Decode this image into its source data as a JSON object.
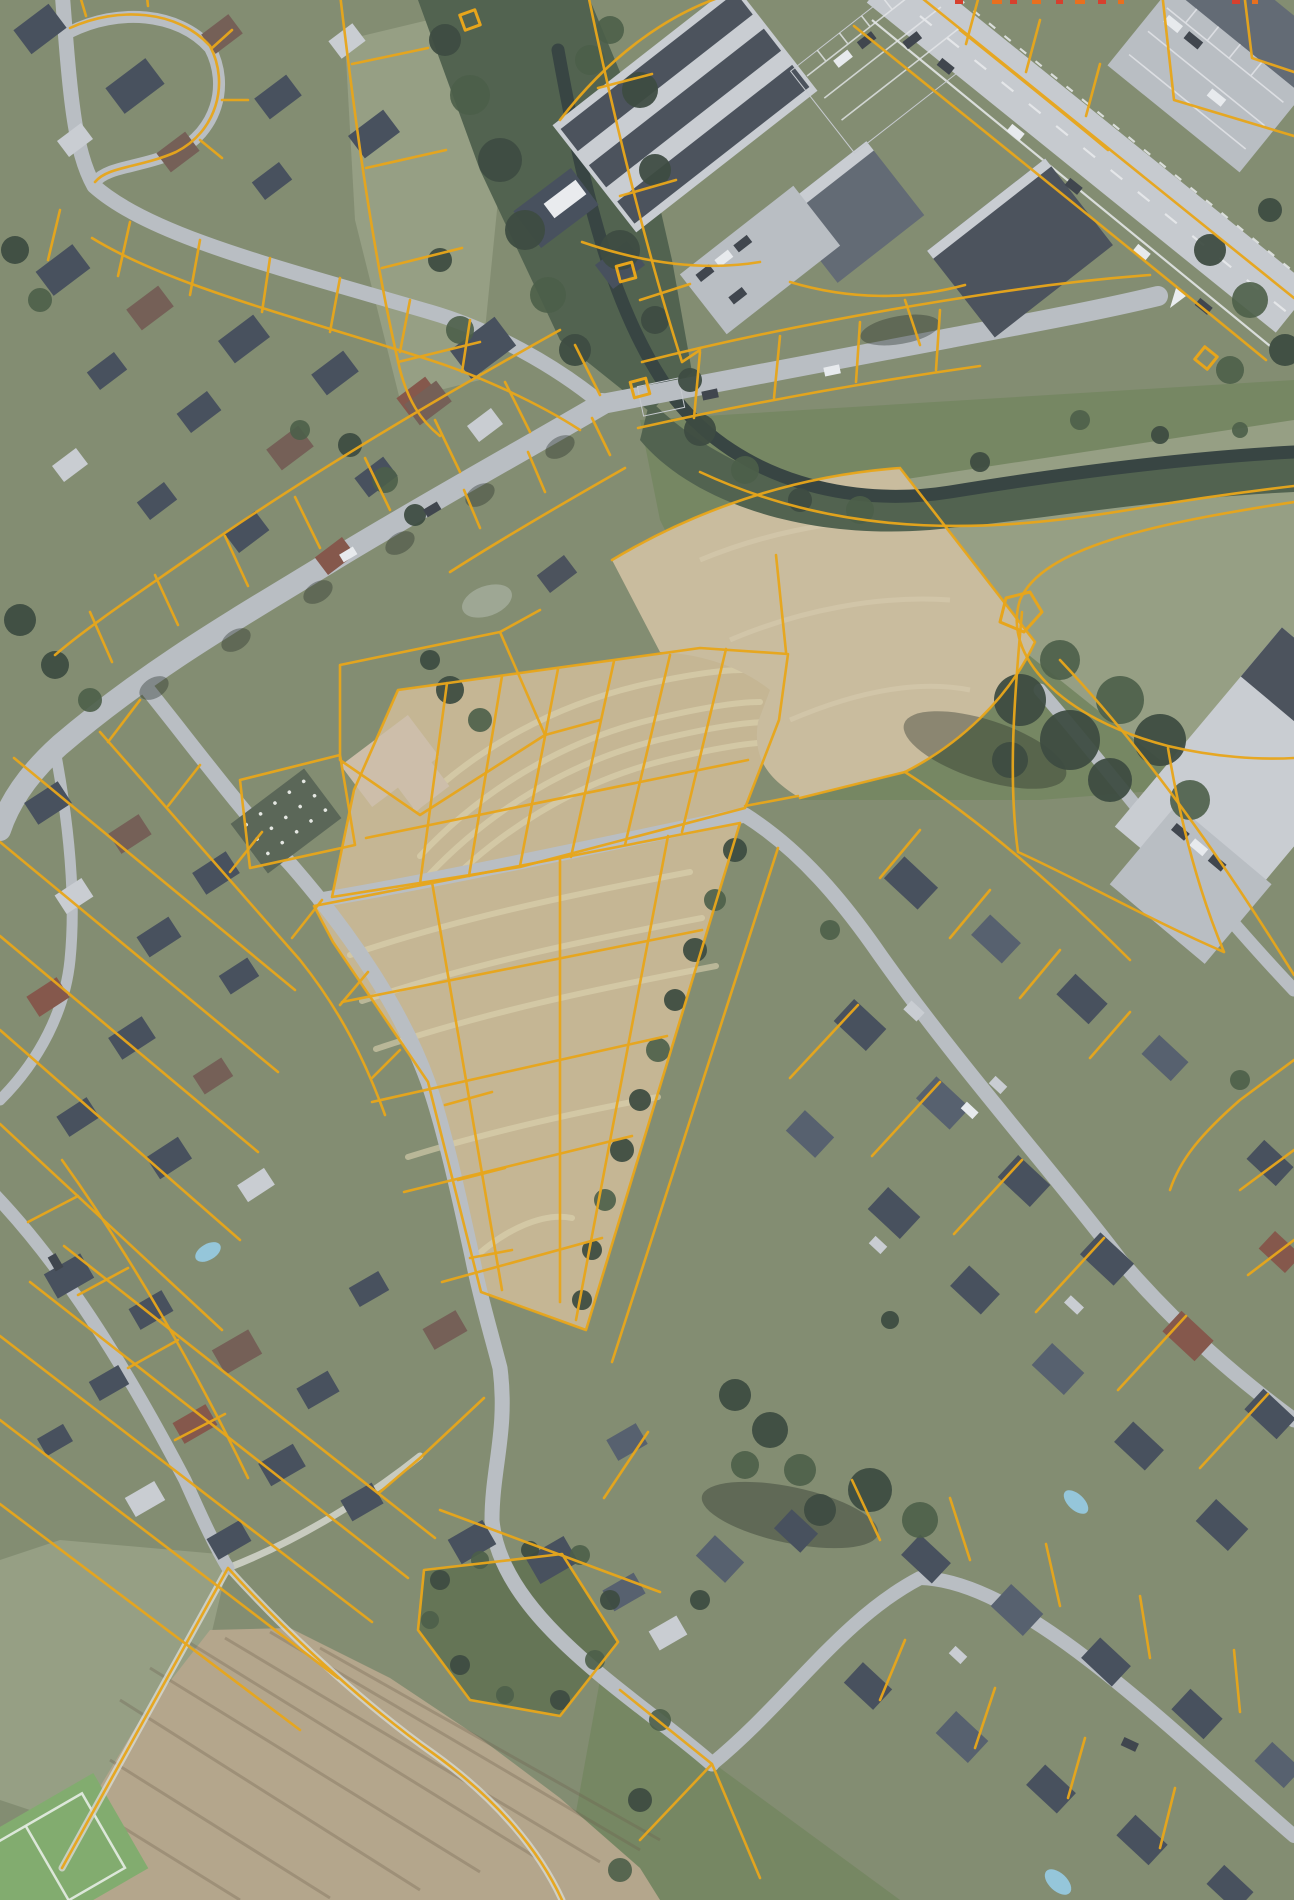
{
  "canvas": {
    "width": 1294,
    "height": 1900
  },
  "scene": {
    "type": "aerial-orthophoto-with-cadastral-overlay",
    "description": "Top-down aerial photograph of a village: residential blocks with yellow cadastral parcel boundaries, a tree-lined stream corridor, an industrial hall with striped roof, a wide arterial road at the top right, harvested tan fields subdivided into building plots in the centre, a plowed field at the bottom left and a new housing development at the lower right.",
    "layers": [
      "orthophoto-basemap",
      "cadastral-parcel-boundaries"
    ],
    "overlay_markers": {
      "square_point_markers": 4,
      "pentagon_point_marker": 1,
      "edge_clip_marks_top": 10
    }
  },
  "colors": {
    "parcel_line": "#e7a51b",
    "road": "#b7bbc0",
    "road_major": "#c6c9cd",
    "road_lane": "#ecedef",
    "track": "#d6d6cb",
    "grass": "#7b8566",
    "grass_light": "#90997a",
    "meadow": "#6d7e55",
    "meadow_dark": "#5a6a47",
    "corridor": "#445640",
    "water": "#273531",
    "field": "#c4b38c",
    "field_stripe": "#e0d3ab",
    "plow": "#b2a183",
    "plow_line": "rgba(96,80,58,0.30)",
    "dirt": "#c9b997",
    "dirt_light": "#d6c7a6",
    "tree": "#2e3d30",
    "tree_mid": "#3e5239",
    "shadow": "rgba(22,30,22,0.38)",
    "roof_dark": "#394250",
    "roof_slate": "#4a5462",
    "roof_brown": "#6b5348",
    "roof_red": "#7d4a3c",
    "roof_light": "#c9ccd1",
    "roof_white": "#eceef0",
    "roof_tan": "#cdbca4",
    "roof_ind": "#575f69",
    "ind_dark": "#3e454f",
    "garden": "#4f5b49",
    "pool": "#8fc5da",
    "pond": "#99a28c",
    "sports": "#7aa863",
    "sports_line": "#e9efe6",
    "car_dark": "#30363e",
    "car_white": "#eaecef",
    "clip_mark": "#d6402e",
    "clip_mark2": "#e8701f",
    "haze": "rgba(205,214,222,0.10)"
  }
}
